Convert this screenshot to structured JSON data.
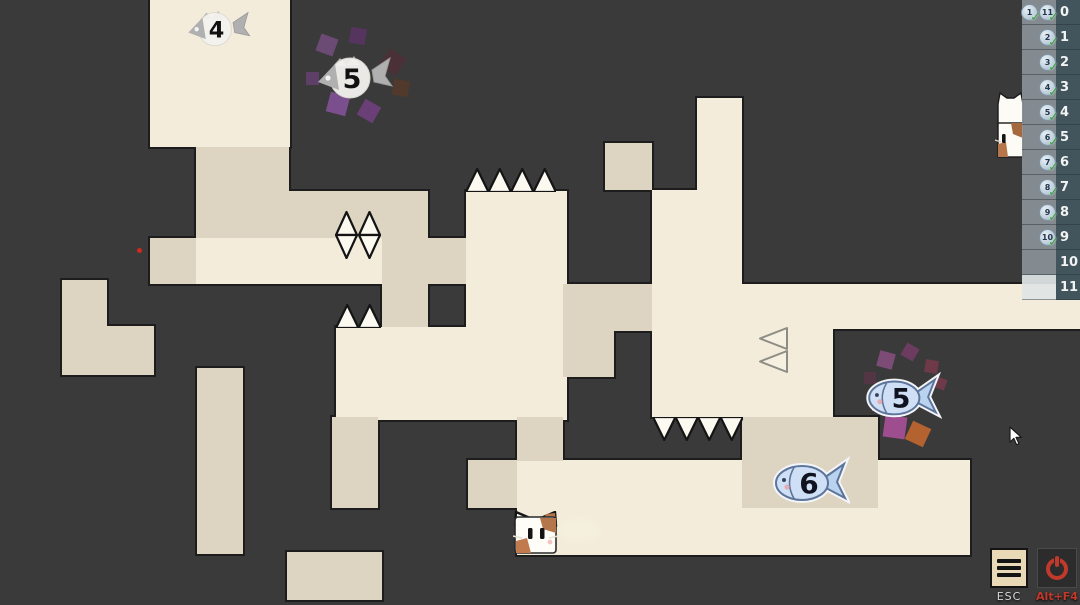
{
  "hud": {
    "esc_label": "ESC",
    "altf4_label": "Alt+F4"
  },
  "sidebar": {
    "rows": [
      {
        "label": "0",
        "badges": [
          "1",
          "11"
        ],
        "highlight": false
      },
      {
        "label": "1",
        "badges": [
          "2"
        ],
        "highlight": false
      },
      {
        "label": "2",
        "badges": [
          "3"
        ],
        "highlight": false
      },
      {
        "label": "3",
        "badges": [
          "4"
        ],
        "highlight": false
      },
      {
        "label": "4",
        "badges": [
          "5"
        ],
        "highlight": false
      },
      {
        "label": "5",
        "badges": [
          "6"
        ],
        "highlight": false
      },
      {
        "label": "6",
        "badges": [
          "7"
        ],
        "highlight": false
      },
      {
        "label": "7",
        "badges": [
          "8"
        ],
        "highlight": false
      },
      {
        "label": "8",
        "badges": [
          "9"
        ],
        "highlight": false
      },
      {
        "label": "9",
        "badges": [
          "10"
        ],
        "highlight": false
      },
      {
        "label": "10",
        "badges": [],
        "highlight": false
      },
      {
        "label": "11",
        "badges": [],
        "highlight": true
      }
    ]
  },
  "game": {
    "background": "#3a3a3a",
    "palette": {
      "light": "#f3ecda",
      "tan": "#ddd5c2",
      "outline": "#1d1d1d",
      "spike_fill": "#fcf9f0",
      "spike_stroke": "#141414",
      "soft_spike_stroke": "#8d8d85",
      "blue_fish_body": "#cfe0f6",
      "blue_fish_stroke": "#5d7599",
      "skeleton_gray": "#b0b0b0",
      "accent_red": "#c0392b"
    },
    "blocks": [
      {
        "x": 150,
        "y": 0,
        "w": 140,
        "h": 147,
        "shade": "light"
      },
      {
        "x": 196,
        "y": 147,
        "w": 93,
        "h": 91,
        "shade": "tan"
      },
      {
        "x": 289,
        "y": 191,
        "w": 139,
        "h": 47,
        "shade": "tan"
      },
      {
        "x": 150,
        "y": 238,
        "w": 46,
        "h": 46,
        "shade": "tan"
      },
      {
        "x": 196,
        "y": 238,
        "w": 186,
        "h": 46,
        "shade": "light"
      },
      {
        "x": 382,
        "y": 238,
        "w": 46,
        "h": 93,
        "shade": "tan"
      },
      {
        "x": 428,
        "y": 238,
        "w": 46,
        "h": 46,
        "shade": "tan"
      },
      {
        "x": 466,
        "y": 191,
        "w": 101,
        "h": 140,
        "shade": "light"
      },
      {
        "x": 336,
        "y": 327,
        "w": 231,
        "h": 93,
        "shade": "light"
      },
      {
        "x": 62,
        "y": 280,
        "w": 45,
        "h": 47,
        "shade": "tan"
      },
      {
        "x": 62,
        "y": 326,
        "w": 92,
        "h": 49,
        "shade": "tan"
      },
      {
        "x": 197,
        "y": 368,
        "w": 46,
        "h": 186,
        "shade": "tan"
      },
      {
        "x": 332,
        "y": 417,
        "w": 46,
        "h": 91,
        "shade": "tan"
      },
      {
        "x": 287,
        "y": 552,
        "w": 95,
        "h": 48,
        "shade": "tan"
      },
      {
        "x": 517,
        "y": 460,
        "w": 453,
        "h": 95,
        "shade": "light"
      },
      {
        "x": 468,
        "y": 460,
        "w": 49,
        "h": 48,
        "shade": "tan"
      },
      {
        "x": 517,
        "y": 417,
        "w": 46,
        "h": 44,
        "shade": "tan"
      },
      {
        "x": 605,
        "y": 143,
        "w": 47,
        "h": 47,
        "shade": "tan"
      },
      {
        "x": 697,
        "y": 98,
        "w": 45,
        "h": 100,
        "shade": "light"
      },
      {
        "x": 652,
        "y": 190,
        "w": 90,
        "h": 100,
        "shade": "light"
      },
      {
        "x": 652,
        "y": 284,
        "w": 181,
        "h": 133,
        "shade": "light"
      },
      {
        "x": 833,
        "y": 284,
        "w": 250,
        "h": 45,
        "shade": "light"
      },
      {
        "x": 563,
        "y": 284,
        "w": 89,
        "h": 47,
        "shade": "tan"
      },
      {
        "x": 563,
        "y": 331,
        "w": 51,
        "h": 46,
        "shade": "tan"
      },
      {
        "x": 742,
        "y": 417,
        "w": 136,
        "h": 91,
        "shade": "tan"
      }
    ],
    "spikes": [
      {
        "type": "up",
        "x": 466,
        "y": 168,
        "w": 90,
        "h": 24,
        "count": 4
      },
      {
        "type": "up",
        "x": 336,
        "y": 304,
        "w": 45,
        "h": 24,
        "count": 2
      },
      {
        "type": "down",
        "x": 653,
        "y": 417,
        "w": 90,
        "h": 24,
        "count": 4
      },
      {
        "type": "left",
        "x": 758,
        "y": 327,
        "w": 30,
        "h": 46,
        "count": 2
      },
      {
        "type": "diamond",
        "x": 335,
        "y": 211,
        "w": 46,
        "h": 48,
        "count": 2
      }
    ],
    "fishes": [
      {
        "value": "4",
        "kind": "skeleton",
        "x": 184,
        "y": 6,
        "w": 70,
        "h": 48
      },
      {
        "value": "5",
        "kind": "skeleton",
        "x": 314,
        "y": 50,
        "w": 82,
        "h": 58
      },
      {
        "value": "5",
        "kind": "blue",
        "x": 864,
        "y": 368,
        "w": 78,
        "h": 56
      },
      {
        "value": "6",
        "kind": "blue",
        "x": 772,
        "y": 452,
        "w": 78,
        "h": 58
      }
    ],
    "particles": [
      {
        "x": 318,
        "y": 36,
        "s": 18,
        "c": "#6b4a74",
        "r": 20
      },
      {
        "x": 350,
        "y": 28,
        "s": 16,
        "c": "#55345e",
        "r": 10
      },
      {
        "x": 383,
        "y": 52,
        "s": 20,
        "c": "#4a3037",
        "r": 35
      },
      {
        "x": 393,
        "y": 80,
        "s": 16,
        "c": "#51392b",
        "r": 10
      },
      {
        "x": 306,
        "y": 72,
        "s": 13,
        "c": "#5e3f68",
        "r": 0
      },
      {
        "x": 328,
        "y": 94,
        "s": 20,
        "c": "#7b4f8e",
        "r": 15
      },
      {
        "x": 360,
        "y": 102,
        "s": 18,
        "c": "#6a3f77",
        "r": 30
      },
      {
        "x": 878,
        "y": 352,
        "s": 16,
        "c": "#7c4b76",
        "r": 15
      },
      {
        "x": 903,
        "y": 345,
        "s": 14,
        "c": "#6b3c60",
        "r": 30
      },
      {
        "x": 925,
        "y": 360,
        "s": 13,
        "c": "#6e3a4a",
        "r": 10
      },
      {
        "x": 864,
        "y": 372,
        "s": 12,
        "c": "#523644",
        "r": 0
      },
      {
        "x": 935,
        "y": 378,
        "s": 11,
        "c": "#6e3a4a",
        "r": 20
      },
      {
        "x": 884,
        "y": 416,
        "s": 22,
        "c": "#9e4d8e",
        "r": 8
      },
      {
        "x": 908,
        "y": 424,
        "s": 20,
        "c": "#b4622f",
        "r": 25
      },
      {
        "x": 872,
        "y": 398,
        "s": 13,
        "c": "#a06a7a",
        "r": 0
      }
    ],
    "player": {
      "x": 513,
      "y": 511,
      "w": 45,
      "h": 43
    },
    "cat_tower": {
      "x": 995,
      "y": 92,
      "w": 30,
      "h": 66
    },
    "red_dot": {
      "x": 137,
      "y": 248
    },
    "dust": {
      "x": 556,
      "y": 517
    },
    "cursor": {
      "x": 1009,
      "y": 426
    }
  }
}
